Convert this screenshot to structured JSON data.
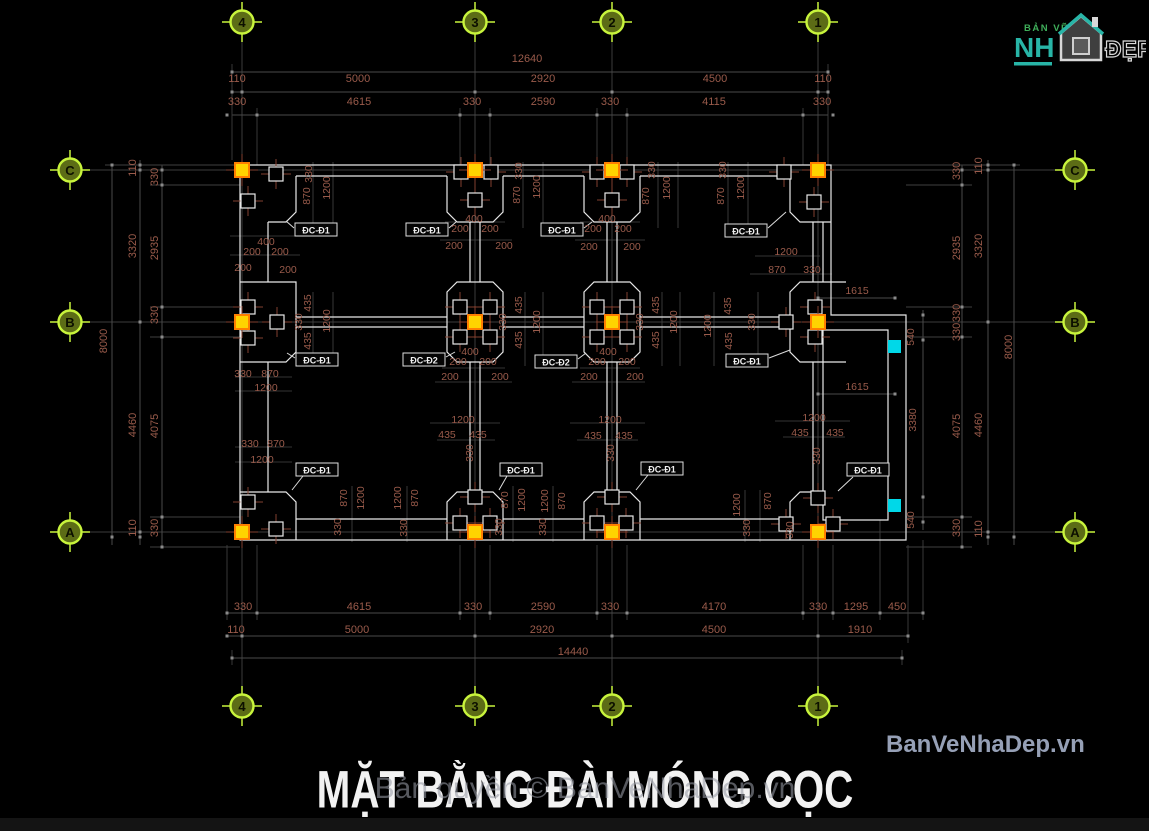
{
  "meta": {
    "title": "MẶT BẰNG ĐÀI MÓNG CỌC",
    "watermark": "Bản quyền © BanVeNhaDep.vn",
    "site": "BanVeNhaDep.vn"
  },
  "logo": {
    "top": "BẢN VẼ",
    "main": "NH",
    "accent": "ĐẸP"
  },
  "colors": {
    "dim_text": "#9a5b4b",
    "outline": "#e8e8e8",
    "grid": "#3c3c3c",
    "dim_line": "#4a4a4a",
    "axis_bubble_ring": "#c8f43c",
    "axis_bubble_fill": "#5c6c16",
    "marker_yellow": "#ffd400",
    "marker_yellow_border": "#ff7f00",
    "marker_cyan": "#00d8e8",
    "cross": "#82402f",
    "logo_green": "#3fae5a",
    "logo_teal": "#28b5a7",
    "site_text": "#96a0b6"
  },
  "axes": {
    "top": [
      {
        "l": "4",
        "x": 242
      },
      {
        "l": "3",
        "x": 475
      },
      {
        "l": "2",
        "x": 612
      },
      {
        "l": "1",
        "x": 818
      }
    ],
    "bottom": [
      {
        "l": "4",
        "x": 242
      },
      {
        "l": "3",
        "x": 475
      },
      {
        "l": "2",
        "x": 612
      },
      {
        "l": "1",
        "x": 818
      }
    ],
    "left": [
      {
        "l": "C",
        "y": 170
      },
      {
        "l": "B",
        "y": 322
      },
      {
        "l": "A",
        "y": 532
      }
    ],
    "right": [
      {
        "l": "C",
        "y": 170
      },
      {
        "l": "B",
        "y": 322
      },
      {
        "l": "A",
        "y": 532
      }
    ]
  },
  "drawing": {
    "dims": [
      [
        "12640",
        527,
        59
      ],
      [
        "110",
        237,
        79
      ],
      [
        "5000",
        358,
        79
      ],
      [
        "2920",
        543,
        79
      ],
      [
        "4500",
        715,
        79
      ],
      [
        "110",
        823,
        79
      ],
      [
        "330",
        237,
        102
      ],
      [
        "4615",
        359,
        102
      ],
      [
        "330",
        472,
        102
      ],
      [
        "2590",
        543,
        102
      ],
      [
        "330",
        610,
        102
      ],
      [
        "4115",
        714,
        102
      ],
      [
        "330",
        822,
        102
      ],
      [
        "330",
        243,
        607
      ],
      [
        "4615",
        359,
        607
      ],
      [
        "330",
        473,
        607
      ],
      [
        "2590",
        543,
        607
      ],
      [
        "330",
        610,
        607
      ],
      [
        "4170",
        714,
        607
      ],
      [
        "330",
        818,
        607
      ],
      [
        "1295",
        856,
        607
      ],
      [
        "450",
        897,
        607
      ],
      [
        "110",
        236,
        630
      ],
      [
        "5000",
        357,
        630
      ],
      [
        "2920",
        542,
        630
      ],
      [
        "4500",
        714,
        630
      ],
      [
        "1910",
        860,
        630
      ],
      [
        "14440",
        573,
        652
      ],
      [
        "110",
        133,
        168,
        1
      ],
      [
        "330",
        155,
        177,
        1
      ],
      [
        "3320",
        133,
        246,
        1
      ],
      [
        "2935",
        155,
        248,
        1
      ],
      [
        "330",
        155,
        315,
        1
      ],
      [
        "8000",
        104,
        341,
        1
      ],
      [
        "4460",
        133,
        425,
        1
      ],
      [
        "4075",
        155,
        426,
        1
      ],
      [
        "110",
        133,
        528,
        1
      ],
      [
        "330",
        155,
        528,
        1
      ],
      [
        "330",
        957,
        171,
        1
      ],
      [
        "110",
        979,
        166,
        1
      ],
      [
        "2935",
        957,
        248,
        1
      ],
      [
        "3320",
        979,
        246,
        1
      ],
      [
        "330",
        957,
        313,
        1
      ],
      [
        "330",
        957,
        332,
        1
      ],
      [
        "8000",
        1009,
        347,
        1
      ],
      [
        "4075",
        957,
        426,
        1
      ],
      [
        "4460",
        979,
        425,
        1
      ],
      [
        "330",
        957,
        528,
        1
      ],
      [
        "110",
        979,
        529,
        1
      ],
      [
        "330",
        309,
        174,
        1
      ],
      [
        "870",
        307,
        196,
        1
      ],
      [
        "1200",
        327,
        188,
        1
      ],
      [
        "400",
        266,
        242
      ],
      [
        "200",
        252,
        252
      ],
      [
        "200",
        280,
        252
      ],
      [
        "200",
        243,
        268
      ],
      [
        "200",
        288,
        270
      ],
      [
        "330",
        519,
        171,
        1
      ],
      [
        "870",
        517,
        195,
        1
      ],
      [
        "1200",
        537,
        187,
        1
      ],
      [
        "400",
        474,
        219
      ],
      [
        "200",
        460,
        229
      ],
      [
        "200",
        490,
        229
      ],
      [
        "200",
        454,
        246
      ],
      [
        "200",
        504,
        246
      ],
      [
        "330",
        652,
        170,
        1
      ],
      [
        "870",
        646,
        196,
        1
      ],
      [
        "1200",
        667,
        188,
        1
      ],
      [
        "400",
        607,
        219
      ],
      [
        "200",
        593,
        229
      ],
      [
        "200",
        623,
        229
      ],
      [
        "200",
        589,
        247
      ],
      [
        "200",
        632,
        247
      ],
      [
        "330",
        723,
        170,
        1
      ],
      [
        "870",
        721,
        196,
        1
      ],
      [
        "1200",
        741,
        188,
        1
      ],
      [
        "1200",
        786,
        252
      ],
      [
        "870",
        777,
        270
      ],
      [
        "330",
        812,
        270
      ],
      [
        "435",
        308,
        303,
        1
      ],
      [
        "330",
        299,
        322,
        1
      ],
      [
        "435",
        308,
        341,
        1
      ],
      [
        "1200",
        327,
        321,
        1
      ],
      [
        "330",
        243,
        374
      ],
      [
        "870",
        270,
        374
      ],
      [
        "1200",
        266,
        388
      ],
      [
        "435",
        519,
        305,
        1
      ],
      [
        "435",
        519,
        340,
        1
      ],
      [
        "1200",
        537,
        322,
        1
      ],
      [
        "330",
        503,
        322,
        1
      ],
      [
        "400",
        470,
        352
      ],
      [
        "200",
        458,
        362
      ],
      [
        "200",
        488,
        362
      ],
      [
        "200",
        450,
        377
      ],
      [
        "200",
        500,
        377
      ],
      [
        "435",
        656,
        305,
        1
      ],
      [
        "435",
        656,
        340,
        1
      ],
      [
        "1200",
        674,
        322,
        1
      ],
      [
        "330",
        640,
        322,
        1
      ],
      [
        "400",
        608,
        352
      ],
      [
        "200",
        597,
        362
      ],
      [
        "200",
        627,
        362
      ],
      [
        "200",
        589,
        377
      ],
      [
        "200",
        635,
        377
      ],
      [
        "1200",
        708,
        326,
        1
      ],
      [
        "435",
        728,
        306,
        1
      ],
      [
        "435",
        729,
        341,
        1
      ],
      [
        "330",
        752,
        322,
        1
      ],
      [
        "1615",
        857,
        291
      ],
      [
        "540",
        911,
        337,
        1
      ],
      [
        "1615",
        857,
        387
      ],
      [
        "3380",
        913,
        420,
        1
      ],
      [
        "540",
        911,
        520,
        1
      ],
      [
        "330",
        250,
        444
      ],
      [
        "870",
        276,
        444
      ],
      [
        "1200",
        262,
        460
      ],
      [
        "1200",
        463,
        420
      ],
      [
        "435",
        447,
        435
      ],
      [
        "435",
        478,
        435
      ],
      [
        "330",
        470,
        453,
        1
      ],
      [
        "1200",
        610,
        420
      ],
      [
        "435",
        593,
        436
      ],
      [
        "435",
        624,
        436
      ],
      [
        "330",
        611,
        453,
        1
      ],
      [
        "1200",
        814,
        418
      ],
      [
        "435",
        800,
        433
      ],
      [
        "435",
        835,
        433
      ],
      [
        "330",
        817,
        456,
        1
      ],
      [
        "870",
        344,
        498,
        1
      ],
      [
        "1200",
        361,
        498,
        1
      ],
      [
        "1200",
        398,
        498,
        1
      ],
      [
        "870",
        415,
        498,
        1
      ],
      [
        "330",
        338,
        527,
        1
      ],
      [
        "330",
        404,
        528,
        1
      ],
      [
        "870",
        505,
        500,
        1
      ],
      [
        "1200",
        522,
        500,
        1
      ],
      [
        "1200",
        545,
        501,
        1
      ],
      [
        "870",
        562,
        501,
        1
      ],
      [
        "330",
        499,
        527,
        1
      ],
      [
        "330",
        543,
        527,
        1
      ],
      [
        "1200",
        737,
        505,
        1
      ],
      [
        "870",
        768,
        501,
        1
      ],
      [
        "330",
        747,
        528,
        1
      ],
      [
        "330",
        790,
        530,
        1
      ]
    ],
    "tags": [
      [
        "ĐC-Đ1",
        316,
        230
      ],
      [
        "ĐC-Đ1",
        427,
        230
      ],
      [
        "ĐC-Đ1",
        562,
        230
      ],
      [
        "ĐC-Đ1",
        746,
        231
      ],
      [
        "ĐC-Đ1",
        317,
        360
      ],
      [
        "ĐC-Đ2",
        424,
        360
      ],
      [
        "ĐC-Đ2",
        556,
        362
      ],
      [
        "ĐC-Đ1",
        747,
        361
      ],
      [
        "ĐC-Đ1",
        317,
        470
      ],
      [
        "ĐC-Đ1",
        521,
        470
      ],
      [
        "ĐC-Đ1",
        662,
        469
      ],
      [
        "ĐC-Đ1",
        868,
        470
      ]
    ],
    "markers": {
      "yellow": [
        [
          242,
          170
        ],
        [
          475,
          170
        ],
        [
          612,
          170
        ],
        [
          818,
          170
        ],
        [
          242,
          322
        ],
        [
          475,
          322
        ],
        [
          612,
          322
        ],
        [
          818,
          322
        ],
        [
          242,
          532
        ],
        [
          475,
          532
        ],
        [
          612,
          532
        ],
        [
          818,
          532
        ]
      ],
      "piles": [
        [
          276,
          174
        ],
        [
          248,
          201
        ],
        [
          461,
          172
        ],
        [
          491,
          172
        ],
        [
          475,
          200
        ],
        [
          597,
          172
        ],
        [
          627,
          172
        ],
        [
          612,
          200
        ],
        [
          784,
          172
        ],
        [
          814,
          202
        ],
        [
          248,
          307
        ],
        [
          248,
          338
        ],
        [
          277,
          322
        ],
        [
          460,
          307
        ],
        [
          490,
          307
        ],
        [
          460,
          337
        ],
        [
          490,
          337
        ],
        [
          597,
          307
        ],
        [
          627,
          307
        ],
        [
          597,
          337
        ],
        [
          627,
          337
        ],
        [
          786,
          322
        ],
        [
          815,
          307
        ],
        [
          815,
          337
        ],
        [
          276,
          529
        ],
        [
          248,
          502
        ],
        [
          460,
          523
        ],
        [
          490,
          523
        ],
        [
          475,
          497
        ],
        [
          597,
          523
        ],
        [
          626,
          523
        ],
        [
          612,
          497
        ],
        [
          786,
          524
        ],
        [
          833,
          524
        ],
        [
          818,
          498
        ]
      ],
      "cyan": [
        [
          895,
          347
        ],
        [
          895,
          506
        ]
      ]
    }
  }
}
